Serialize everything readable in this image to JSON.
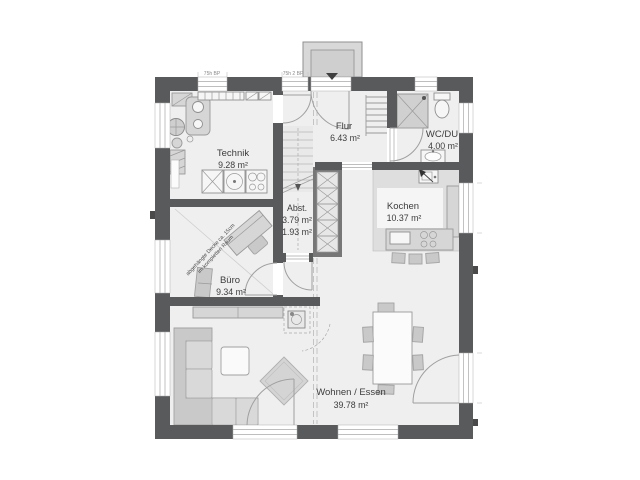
{
  "rooms": {
    "technik": {
      "name": "Technik",
      "area": "9.28 m²"
    },
    "flur": {
      "name": "Flur",
      "area": "6.43 m²"
    },
    "wc": {
      "name": "WC/DU",
      "area": "4.00 m²"
    },
    "abst": {
      "name": "Abst.",
      "area1": "3.79 m²",
      "area2": "1.93 m²"
    },
    "kochen": {
      "name": "Kochen",
      "area": "10.37 m²"
    },
    "buero": {
      "name": "Büro",
      "area": "9.34 m²"
    },
    "wohnen": {
      "name": "Wohnen / Essen",
      "area": "39.78 m²"
    }
  },
  "annotations": {
    "ceiling_note_line1": "abgehängte Decke ca. 15cm",
    "ceiling_note_line2": "im kompletten Raum",
    "window_label_left": "75h BP",
    "window_label_right": "75h 2 BP"
  },
  "colors": {
    "wall": "#585a5c",
    "floor": "#efefef",
    "kzone": "#dedede",
    "furn": "#d6d6d6",
    "fstroke": "#9a9a9a",
    "text": "#3c3c3c"
  }
}
